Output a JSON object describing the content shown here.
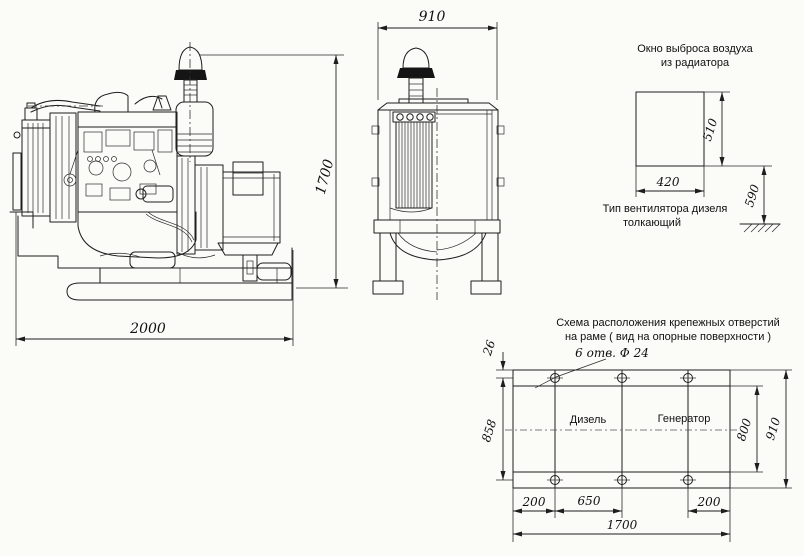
{
  "side_view": {
    "length": "2000",
    "height": "1700"
  },
  "front_view": {
    "width": "910"
  },
  "air_window": {
    "title1": "Окно выброса воздуха",
    "title2": "из радиатора",
    "w": "420",
    "h": "510",
    "ground": "590",
    "note1": "Тип вентилятора дизеля",
    "note2": "толкающий"
  },
  "frame_plan": {
    "title1": "Схема расположения крепежных отверстий",
    "title2": "на раме ( вид на опорные поверхности )",
    "holes_note": "6 отв. Ф 24",
    "diesel": "Дизель",
    "generator": "Генератор",
    "edge_offset": "26",
    "hole_rows_span": "858",
    "inner_span": "800",
    "frame_width": "910",
    "end_offset_left": "200",
    "hole_pitch": "650",
    "end_offset_right": "200",
    "holes_length": "1700"
  }
}
